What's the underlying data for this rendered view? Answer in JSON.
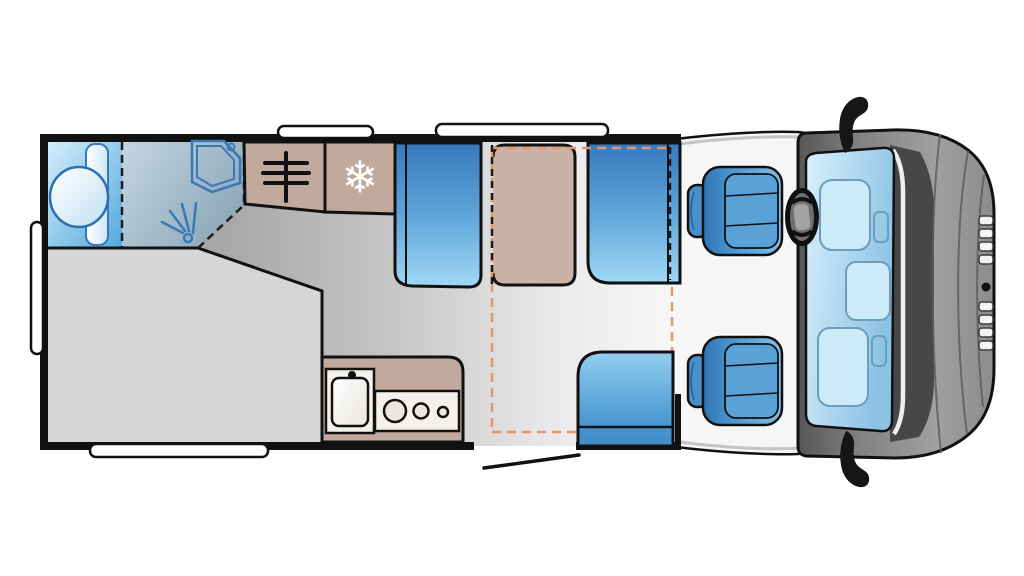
{
  "diagram": {
    "kind": "motorhome-floorplan-top-view",
    "vehicle_front": "right",
    "areas": [
      {
        "name": "washroom",
        "features": [
          "washbasin",
          "cistern",
          "corner-shower-tray",
          "shower-drain",
          "shower-spray",
          "dashed-door-line"
        ]
      },
      {
        "name": "wardrobe",
        "features": [
          "hanging-rail-icon"
        ]
      },
      {
        "name": "refrigerator",
        "features": [
          "snowflake-icon"
        ]
      },
      {
        "name": "rear-bed",
        "features": [
          "angled-foot-corner"
        ]
      },
      {
        "name": "kitchen",
        "features": [
          "sink",
          "tap",
          "three-burner-hob"
        ]
      },
      {
        "name": "dinette",
        "features": [
          "table",
          "forward-bench-seat",
          "rearward-bench-seat",
          "drop-down-bed-dashed-outline"
        ]
      },
      {
        "name": "entrance",
        "features": [
          "door-opening",
          "door-swing-line",
          "side-seat"
        ]
      },
      {
        "name": "cab",
        "features": [
          "driver-seat",
          "passenger-seat",
          "steering-wheel",
          "windshield",
          "dashboard",
          "wing-mirror-top",
          "wing-mirror-bottom",
          "front-grille"
        ]
      }
    ],
    "exterior_features": [
      "rear-window",
      "side-window-bottom",
      "roof-vent-small",
      "roof-vent-large"
    ]
  },
  "icons": {
    "snowflake_glyph": "❄",
    "snowflake_meaning": "fridge-freezer",
    "hanging_rail_meaning": "wardrobe",
    "shower_spray_meaning": "shower"
  },
  "colors": {
    "wall_black": "#111111",
    "cabinet_tan": "#c2a99d",
    "table_tan": "#c9b2a6",
    "seat_blue_dark": "#3679bd",
    "seat_blue_light": "#a0d8f4",
    "bathroom_blue": "#54a8dd",
    "shower_grey_blue": "#8ea8b9",
    "bed_grey": "#d6d6d6",
    "floor_grey_dark": "#9d9d9d",
    "floor_grey_light": "#f7f7f7",
    "bed_marker_orange": "#e8946c",
    "cab_body_grey": "#8c8c8c",
    "windshield_blue": "#bcdcf2",
    "window_white": "#ffffff",
    "fixture_outline_blue": "#3a79b8"
  }
}
